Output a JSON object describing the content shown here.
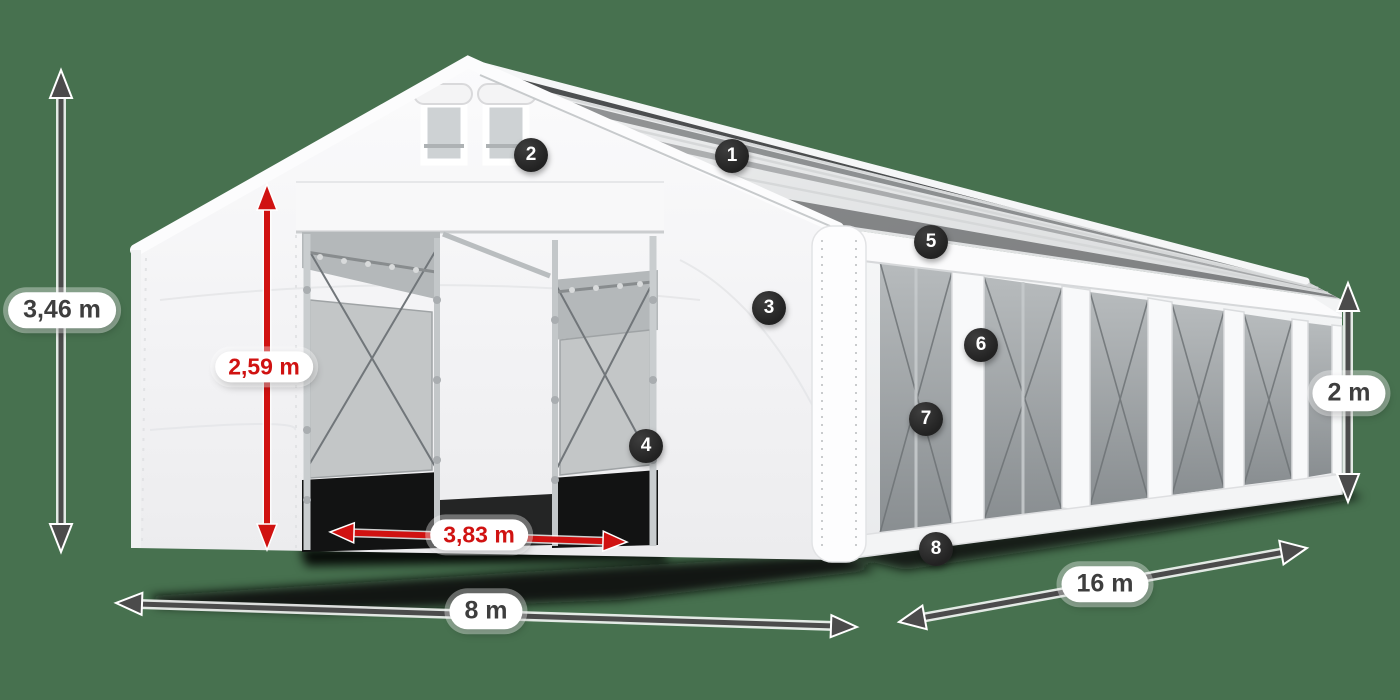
{
  "canvas": {
    "background_color": "#47714f",
    "red_accent_color": "#d01211",
    "dimension_arrow_color": "#4b4b4b",
    "badge_color": "#2b2b2b",
    "tent_color": "#f5f5f6",
    "mesh_color": "#aeb3b5"
  },
  "dimensions": {
    "total_height": {
      "label": "3,46 m",
      "style": "dark"
    },
    "entrance_height": {
      "label": "2,59 m",
      "style": "red"
    },
    "entrance_width": {
      "label": "3,83 m",
      "style": "red"
    },
    "tent_width": {
      "label": "8 m",
      "style": "dark"
    },
    "tent_length": {
      "label": "16 m",
      "style": "dark"
    },
    "side_height": {
      "label": "2 m",
      "style": "dark"
    }
  },
  "callouts": [
    {
      "number": "1"
    },
    {
      "number": "2"
    },
    {
      "number": "3"
    },
    {
      "number": "4"
    },
    {
      "number": "5"
    },
    {
      "number": "6"
    },
    {
      "number": "7"
    },
    {
      "number": "8"
    }
  ]
}
